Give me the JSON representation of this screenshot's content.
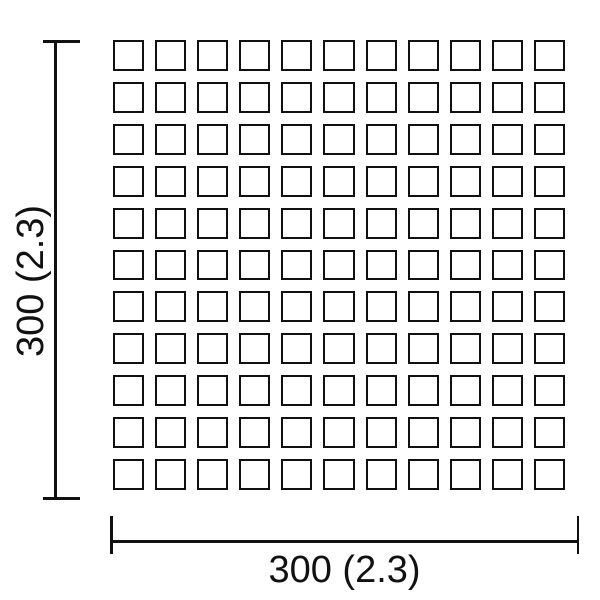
{
  "drawing": {
    "description": "tile sheet dimension drawing",
    "grid": {
      "rows": 11,
      "cols": 11
    },
    "vertical_dimension": {
      "label": "300 (2.3)"
    },
    "horizontal_dimension": {
      "label": "300 (2.3)"
    },
    "colors": {
      "line": "#111111",
      "background": "#ffffff",
      "text": "#111111"
    }
  }
}
